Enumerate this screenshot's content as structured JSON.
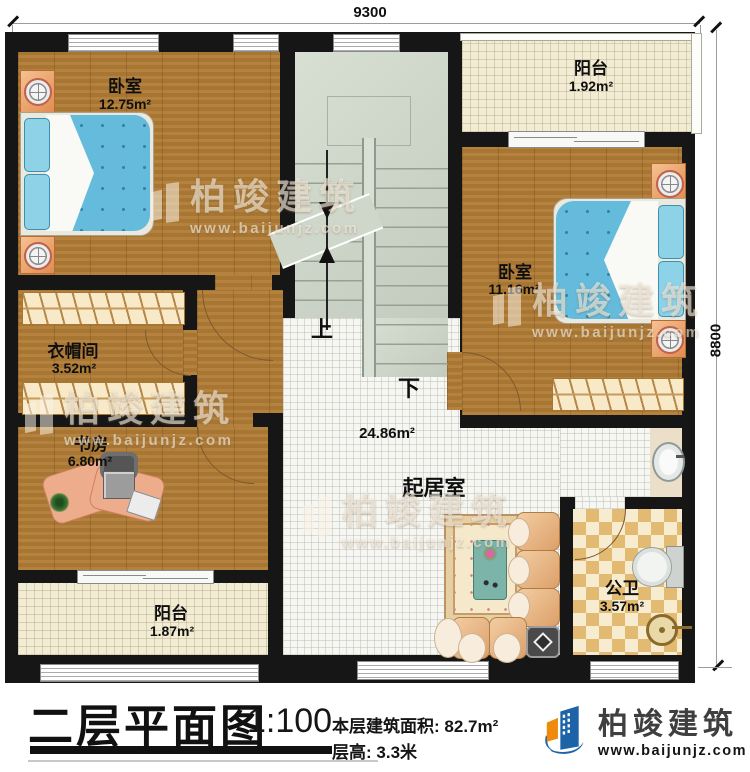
{
  "dimensions": {
    "top": "9300",
    "right": "8800"
  },
  "rooms": {
    "bedroom1": {
      "name": "卧室",
      "area": "12.75m²"
    },
    "balcony_top": {
      "name": "阳台",
      "area": "1.92m²"
    },
    "bedroom2": {
      "name": "卧室",
      "area": "11.16m²"
    },
    "cloakroom": {
      "name": "衣帽间",
      "area": "3.52m²"
    },
    "study": {
      "name": "书房",
      "area": "6.80m²"
    },
    "balcony_bottom": {
      "name": "阳台",
      "area": "1.87m²"
    },
    "living": {
      "name": "起居室",
      "area": "24.86m²"
    },
    "bathroom": {
      "name": "公卫",
      "area": "3.57m²"
    }
  },
  "stairs": {
    "up": "上",
    "down": "下"
  },
  "watermark": {
    "brand": "柏竣建筑",
    "url": "www.baijunjz.com"
  },
  "footer": {
    "title": "二层平面图",
    "scale": "1:100",
    "area_label": "本层建筑面积:",
    "area_value": "82.7m²",
    "height_label": "层高:",
    "height_value": "3.3米",
    "brand": "柏竣建筑",
    "brand_url": "www.baijunjz.com"
  },
  "colors": {
    "wall": "#161616",
    "wood": "#b07c36",
    "accent_blue": "#1c63a8",
    "accent_orange": "#ef8a0d",
    "bed": "#64bbdc"
  }
}
